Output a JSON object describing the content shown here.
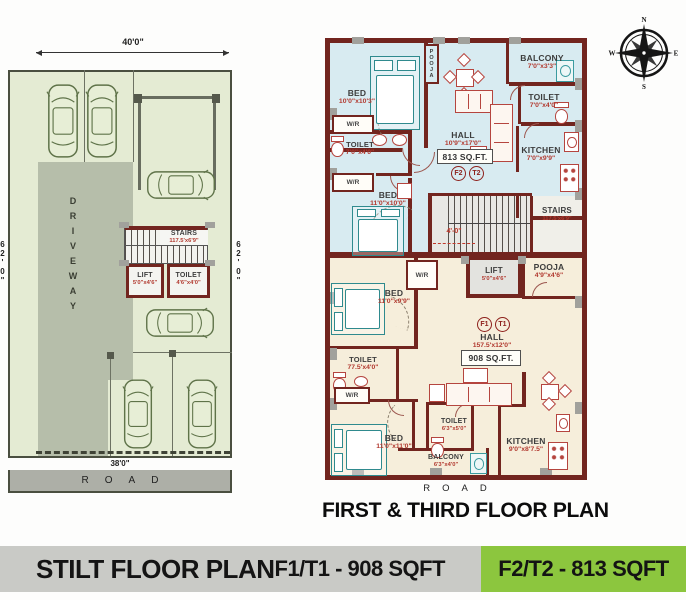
{
  "compass": {
    "north": "N",
    "east": "E",
    "south": "S",
    "west": "W"
  },
  "stilt_plan": {
    "dim_width_top": "40'0\"",
    "dim_width_bottom": "38'0\"",
    "dim_height_left": "62'0\"",
    "dim_height_right": "62'0\"",
    "driveway_label": "DRIVEWAY",
    "road_label": "ROAD",
    "stairs": {
      "name": "STAIRS",
      "dim": "117.5'x6'9\""
    },
    "lift": {
      "name": "LIFT",
      "dim": "5'0\"x4'6\""
    },
    "toilet": {
      "name": "TOILET",
      "dim": "4'6\"x4'0\""
    }
  },
  "floor_plan": {
    "title": "FIRST & THIRD FLOOR PLAN",
    "road_label": "ROAD",
    "stair_front_dim": "4'-0\"",
    "unit_f2": {
      "badge_f": "F2",
      "badge_t": "T2",
      "area": "813 SQ.FT."
    },
    "unit_f1": {
      "badge_f": "F1",
      "badge_t": "T1",
      "area": "908 SQ.FT."
    },
    "rooms": {
      "bed_top_left": {
        "name": "BED",
        "dim": "10'0\"x10'3\""
      },
      "pooja_top": {
        "name": "POOJA"
      },
      "balcony_top": {
        "name": "BALCONY",
        "dim": "7'0\"x3'3\""
      },
      "toilet_top_right": {
        "name": "TOILET",
        "dim": "7'0\"x4'0\""
      },
      "kitchen_top": {
        "name": "KITCHEN",
        "dim": "7'0\"x9'9\""
      },
      "hall_top": {
        "name": "HALL",
        "dim": "10'9\"x17'0\""
      },
      "wr_1": {
        "name": "W/R"
      },
      "toilet_mid_left": {
        "name": "TOILET",
        "dim": "7'0\"x4'0\""
      },
      "wr_2": {
        "name": "W/R"
      },
      "bed_mid_left": {
        "name": "BED",
        "dim": "11'0\"x10'0\""
      },
      "stairs": {
        "name": "STAIRS",
        "dim": "117.5'x6'9\""
      },
      "lift": {
        "name": "LIFT",
        "dim": "5'0\"x4'6\""
      },
      "pooja_mid": {
        "name": "POOJA",
        "dim": "4'9\"x4'6\""
      },
      "wr_3": {
        "name": "W/R"
      },
      "bed_low_left": {
        "name": "BED",
        "dim": "11'0\"x9'9\""
      },
      "hall_bottom": {
        "name": "HALL",
        "dim": "157.5'x12'0\""
      },
      "toilet_low_left": {
        "name": "TOILET",
        "dim": "77.5'x4'0\""
      },
      "wr_4": {
        "name": "W/R"
      },
      "bed_bottom_left": {
        "name": "BED",
        "dim": "11'0\"x11'0\""
      },
      "toilet_bottom_mid": {
        "name": "TOILET",
        "dim": "6'3\"x5'0\""
      },
      "balcony_bottom": {
        "name": "BALCONY",
        "dim": "6'3\"x4'0\""
      },
      "kitchen_bottom": {
        "name": "KITCHEN",
        "dim": "9'0\"x8'7.5\""
      }
    }
  },
  "footer": {
    "stilt_label": "STILT FLOOR PLAN",
    "f1_label": "F1/T1 - 908 SQFT",
    "f2_label": "F2/T2 - 813 SQFT"
  },
  "colors": {
    "wall_maroon": "#72251f",
    "unit_f2_fill": "#d8ebf1",
    "unit_f1_fill": "#f6eedb",
    "site_green": "#e4ebd3",
    "driveway_gray": "#b6beaa",
    "footer_gray": "#c9cac6",
    "footer_green": "#8cc63e"
  }
}
